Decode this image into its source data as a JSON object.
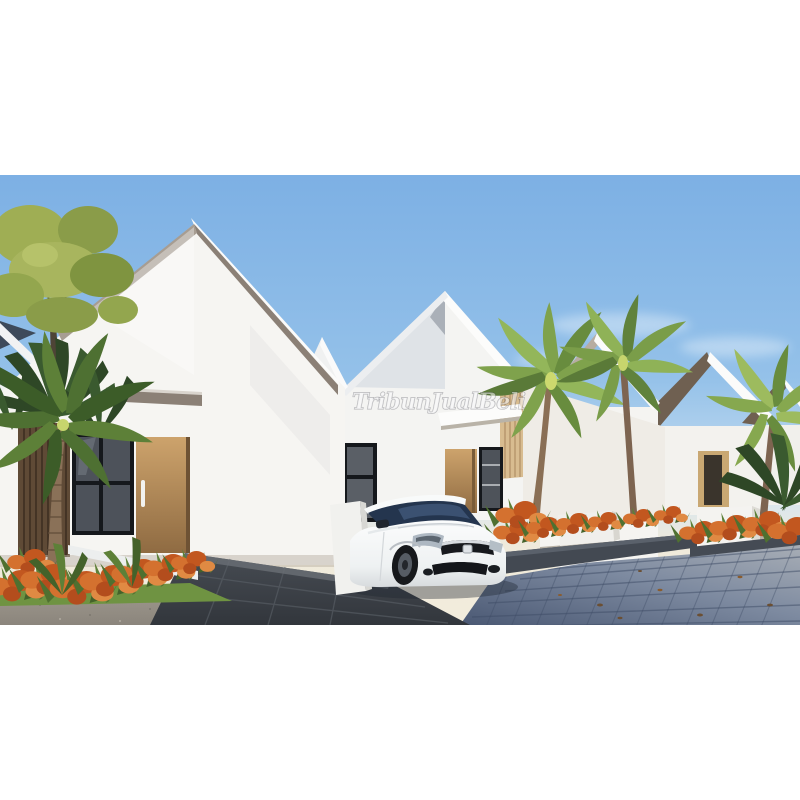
{
  "meta": {
    "kind": "property-listing-photo",
    "description": "3D exterior render of a row of modern minimalist gable-roof houses with palm trees, orange shrubs and a white hatchback car parked on a paver driveway"
  },
  "watermark": {
    "text": "TribunJualBeli"
  },
  "palette": {
    "page_bg": "#ffffff",
    "sky_top": "#7db0e4",
    "sky_mid": "#b9d6ee",
    "horizon_warm": "#f0e9d8",
    "wall_white": "#f6f5f2",
    "wall_shade": "#dfe3e7",
    "fascia_taupe": "#8b8076",
    "roof_brown": "#6f6051",
    "roof_navy": "#3e4a5a",
    "wood_door": "#c49c66",
    "wood_slat": "#5f4a36",
    "wood_batten": "#d8bc90",
    "window_glass": "#4d525a",
    "frame_black": "#15181c",
    "palm_green": "#7fa24c",
    "palm_dark": "#2e4726",
    "fern_green": "#a3b055",
    "flower_orange": "#d4712f",
    "grass_green": "#6f9342",
    "paver_light": "#a8aeb6",
    "paver_dark": "#57657e",
    "gravel_gray": "#999287",
    "driveway_dark": "#3a3f46",
    "planter_cap": "#434952",
    "car_body": "#f4f6f7",
    "car_glass": "#24354e"
  }
}
